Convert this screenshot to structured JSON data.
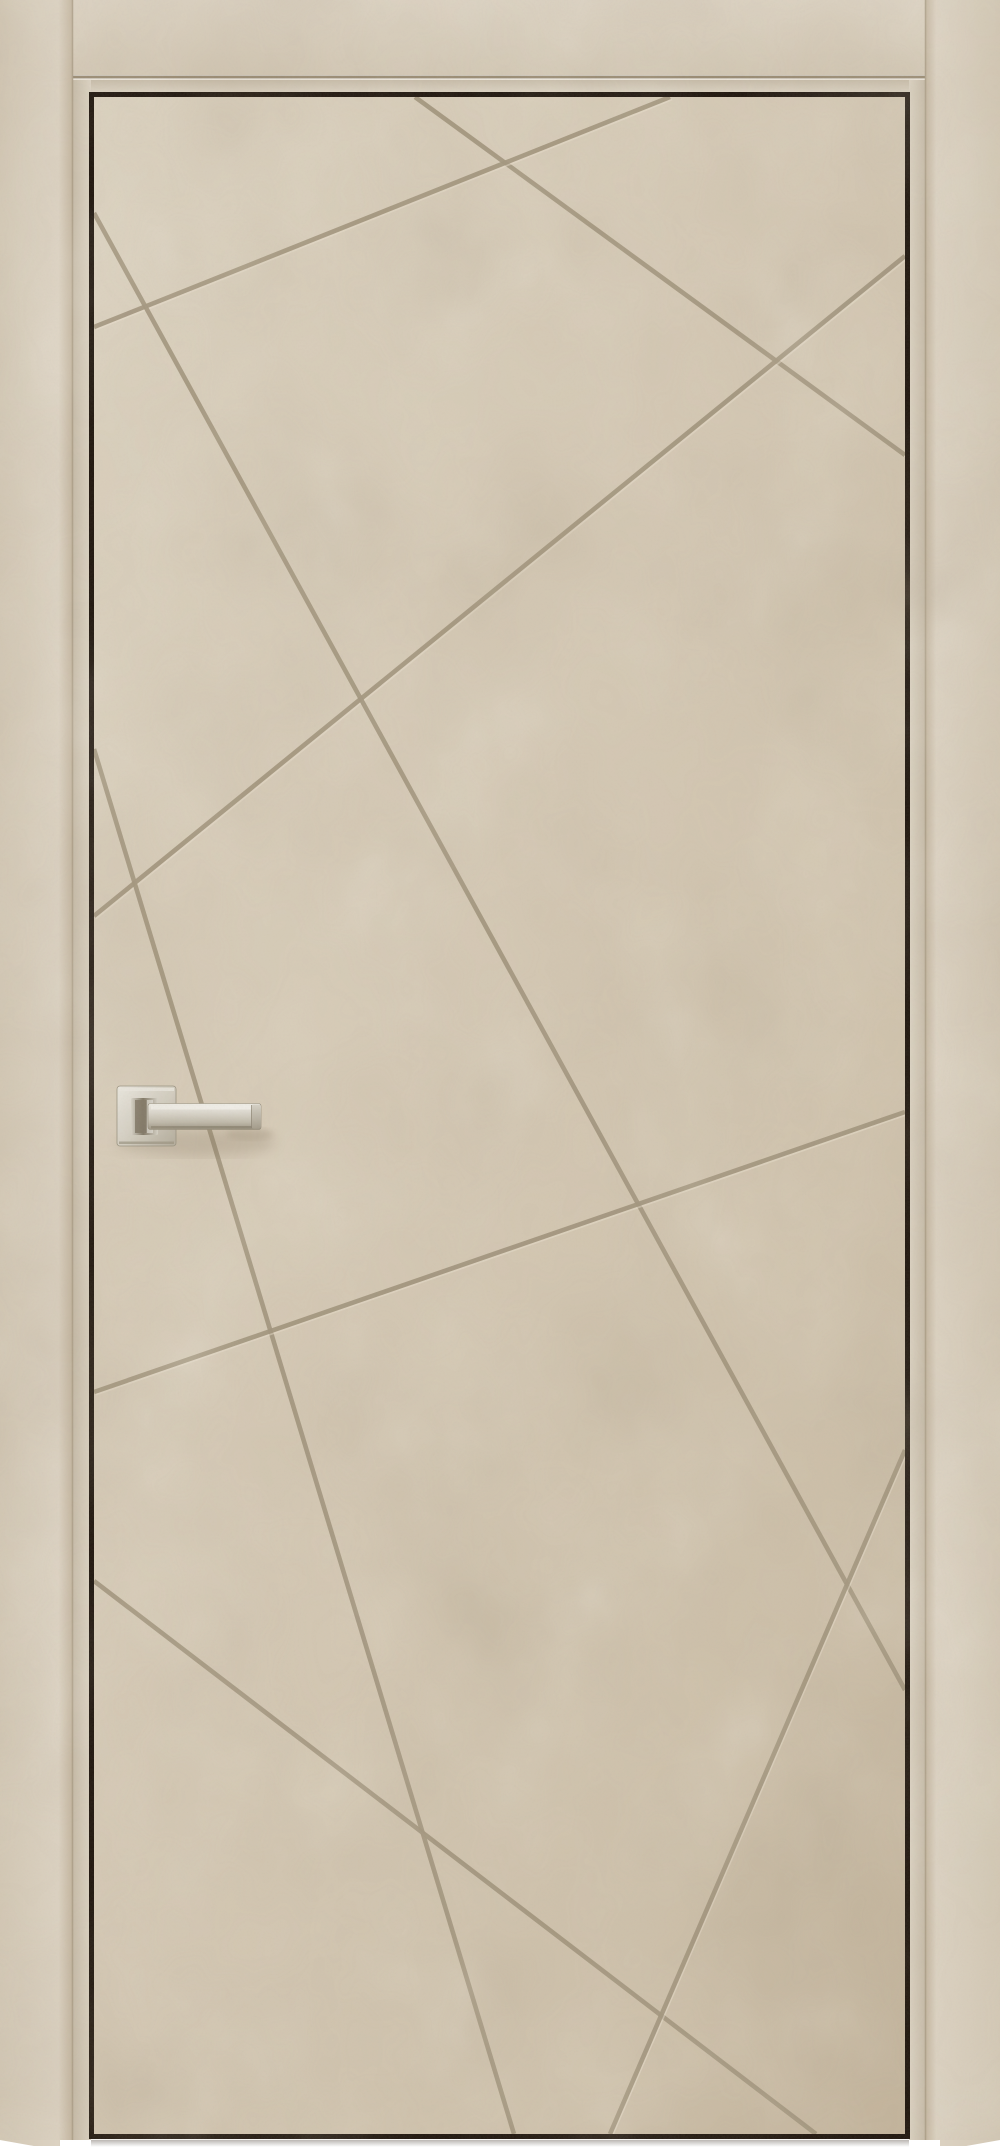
{
  "meta": {
    "subject": "interior-door-product-photo",
    "width": 1000,
    "height": 2151,
    "style": "beige concrete-texture door slab with chaotic diagonal groove pattern, dark edge gap, flush casing, satin nickel square-rose lever handle, white background sliver at floor"
  },
  "palette": {
    "page_bg": "#ffffff",
    "casing_light": "#dcd2c2",
    "casing_base": "#d3c8b5",
    "casing_dark": "#c3b59f",
    "casing_seam": "#a89b84",
    "top_groove": "#998b73",
    "top_groove_highlight": "#e4dbcc",
    "reveal_light": "#dcd3c3",
    "reveal_dark": "#c7bca9",
    "gap_black": "#1d140c",
    "leaf_light": "#dbd1bf",
    "leaf_base": "#d5c9b5",
    "leaf_mid": "#cec1ab",
    "leaf_dark": "#c3b49c",
    "under_shadow": "#6b5d49",
    "rose_hi": "#ebe8e1",
    "rose_mid": "#d2cdc0",
    "rose_lo": "#b2ab9b",
    "rose_edge": "#97907e",
    "neck_light": "#d8d4c9",
    "neck_dark": "#7c7361",
    "lever_hi": "#f2f0ea",
    "lever_mid": "#dcd8ce",
    "lever_lo": "#c0baab",
    "lever_deep": "#9b9382",
    "lever_edge": "#8b8371",
    "cap_hi": "#d5d1c6",
    "cap_lo": "#a59d8c",
    "handle_shadow": "#73644d"
  },
  "frame": {
    "left_casing": {
      "x": 0,
      "y": 0,
      "w": 73,
      "h": 2146
    },
    "right_casing": {
      "x": 925,
      "y": 0,
      "w": 75,
      "h": 2146
    },
    "top_casing": {
      "x": 73,
      "y": 0,
      "w": 852,
      "h": 75
    },
    "reveal_width": 18,
    "gap_outline": {
      "x": 91.5,
      "y": 94.5,
      "w": 816,
      "h": 2042,
      "stroke_width": 5
    }
  },
  "door_leaf": {
    "x": 94,
    "y": 97,
    "w": 811,
    "h": 2038
  },
  "grooves": {
    "color": "#a2957d",
    "highlight": "#ece2d1",
    "width": 4.6,
    "segments": [
      {
        "name": "groove-top-to-right-upper",
        "x1": 415,
        "y1": 97,
        "x2": 905,
        "y2": 455
      },
      {
        "name": "groove-top-to-left-upper",
        "x1": 670,
        "y1": 97,
        "x2": 94,
        "y2": 327
      },
      {
        "name": "groove-right-to-left-long",
        "x1": 905,
        "y1": 256,
        "x2": 94,
        "y2": 916
      },
      {
        "name": "groove-left-to-right-diag",
        "x1": 94,
        "y1": 213,
        "x2": 905,
        "y2": 1690
      },
      {
        "name": "groove-left-steep",
        "x1": 94,
        "y1": 749,
        "x2": 514,
        "y2": 2134
      },
      {
        "name": "groove-left-to-bottom",
        "x1": 94,
        "y1": 1581,
        "x2": 816,
        "y2": 2134
      },
      {
        "name": "groove-right-steep-down",
        "x1": 905,
        "y1": 1450,
        "x2": 610,
        "y2": 2134
      },
      {
        "name": "groove-right-to-left-low",
        "x1": 905,
        "y1": 1112,
        "x2": 94,
        "y2": 1392
      }
    ]
  },
  "handle": {
    "type": "square-rose-lever",
    "finish": "satin-nickel",
    "rose": {
      "x": 117,
      "y": 1086,
      "w": 59,
      "h": 60,
      "rx": 3
    },
    "neck": {
      "x": 131,
      "y": 1098,
      "w": 27,
      "h": 37
    },
    "neck_slot": {
      "x": 135,
      "y": 1100,
      "w": 11,
      "h": 33
    },
    "lever": {
      "x": 148,
      "y": 1103.5,
      "w": 113,
      "h": 26,
      "rx": 2.5
    },
    "lever_cap": {
      "x": 251.5,
      "y": 1104.5,
      "w": 9.5,
      "h": 24
    }
  }
}
